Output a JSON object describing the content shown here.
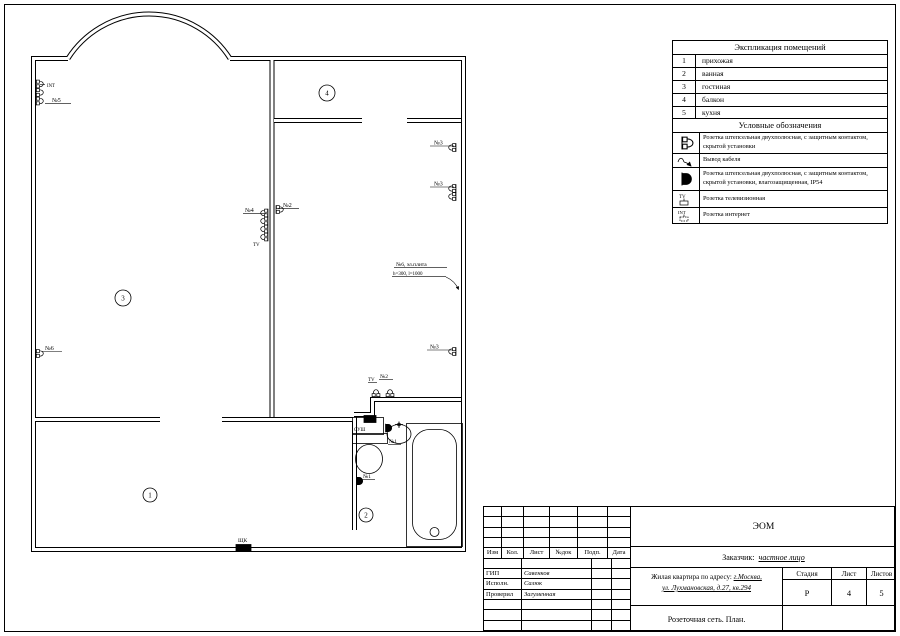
{
  "sheet": {
    "background": "#ffffff",
    "line_color": "#000000"
  },
  "explication": {
    "title": "Экспликация помещений",
    "rows": [
      {
        "num": "1",
        "name": "прихожая"
      },
      {
        "num": "2",
        "name": "ванная"
      },
      {
        "num": "3",
        "name": "гостиная"
      },
      {
        "num": "4",
        "name": "балкон"
      },
      {
        "num": "5",
        "name": "кухня"
      }
    ]
  },
  "legend": {
    "title": "Условные обозначения",
    "rows": [
      {
        "icon": "socket-icon",
        "text": "Розетка штепсельная двухполюсная, с защитным контактом, скрытой установки"
      },
      {
        "icon": "cable-outlet-icon",
        "text": "Вывод кабеля"
      },
      {
        "icon": "waterproof-socket-icon",
        "text": "Розетка штепсельная двухполюсная, с защитным контактом, скрытой установки, влагозащищенная, IP54"
      },
      {
        "icon": "tv-socket-icon",
        "icon_label": "TV",
        "text": "Розетка телевизионная"
      },
      {
        "icon": "internet-socket-icon",
        "icon_label": "INT",
        "text": "Розетка интернет"
      }
    ]
  },
  "plan": {
    "rooms": [
      "1",
      "2",
      "3",
      "4"
    ],
    "labels": [
      "INT",
      "№5",
      "№6",
      "№4",
      "TV",
      "№2",
      "№3",
      "№3",
      "№3",
      "№6, эл.плита",
      "h=300, l=1000",
      "TV",
      "№2",
      "СУШ",
      "№1",
      "№1",
      "ЩК"
    ]
  },
  "titleblock": {
    "code": "ЭОМ",
    "customer_label": "Заказчик:",
    "customer_value": "частное лицо",
    "object_prefix": "Жилая квартира по адресу:",
    "object_addr1": "г.Москва,",
    "object_addr2": "ул. Лухмановская, д.27, кв.294",
    "doc_title": "Розеточная сеть. План.",
    "stage_label": "Стадия",
    "sheet_label": "Лист",
    "sheets_label": "Листов",
    "stage": "Р",
    "sheet_num": "4",
    "sheets_total": "5",
    "columns": [
      "Изм",
      "Кол.",
      "Лист",
      "№док",
      "Подп.",
      "Дата"
    ],
    "signers": [
      {
        "role": "ГИП",
        "name": "Савенков"
      },
      {
        "role": "Исполн.",
        "name": "Салюк"
      },
      {
        "role": "Проверил",
        "name": "Загуменная"
      }
    ]
  }
}
